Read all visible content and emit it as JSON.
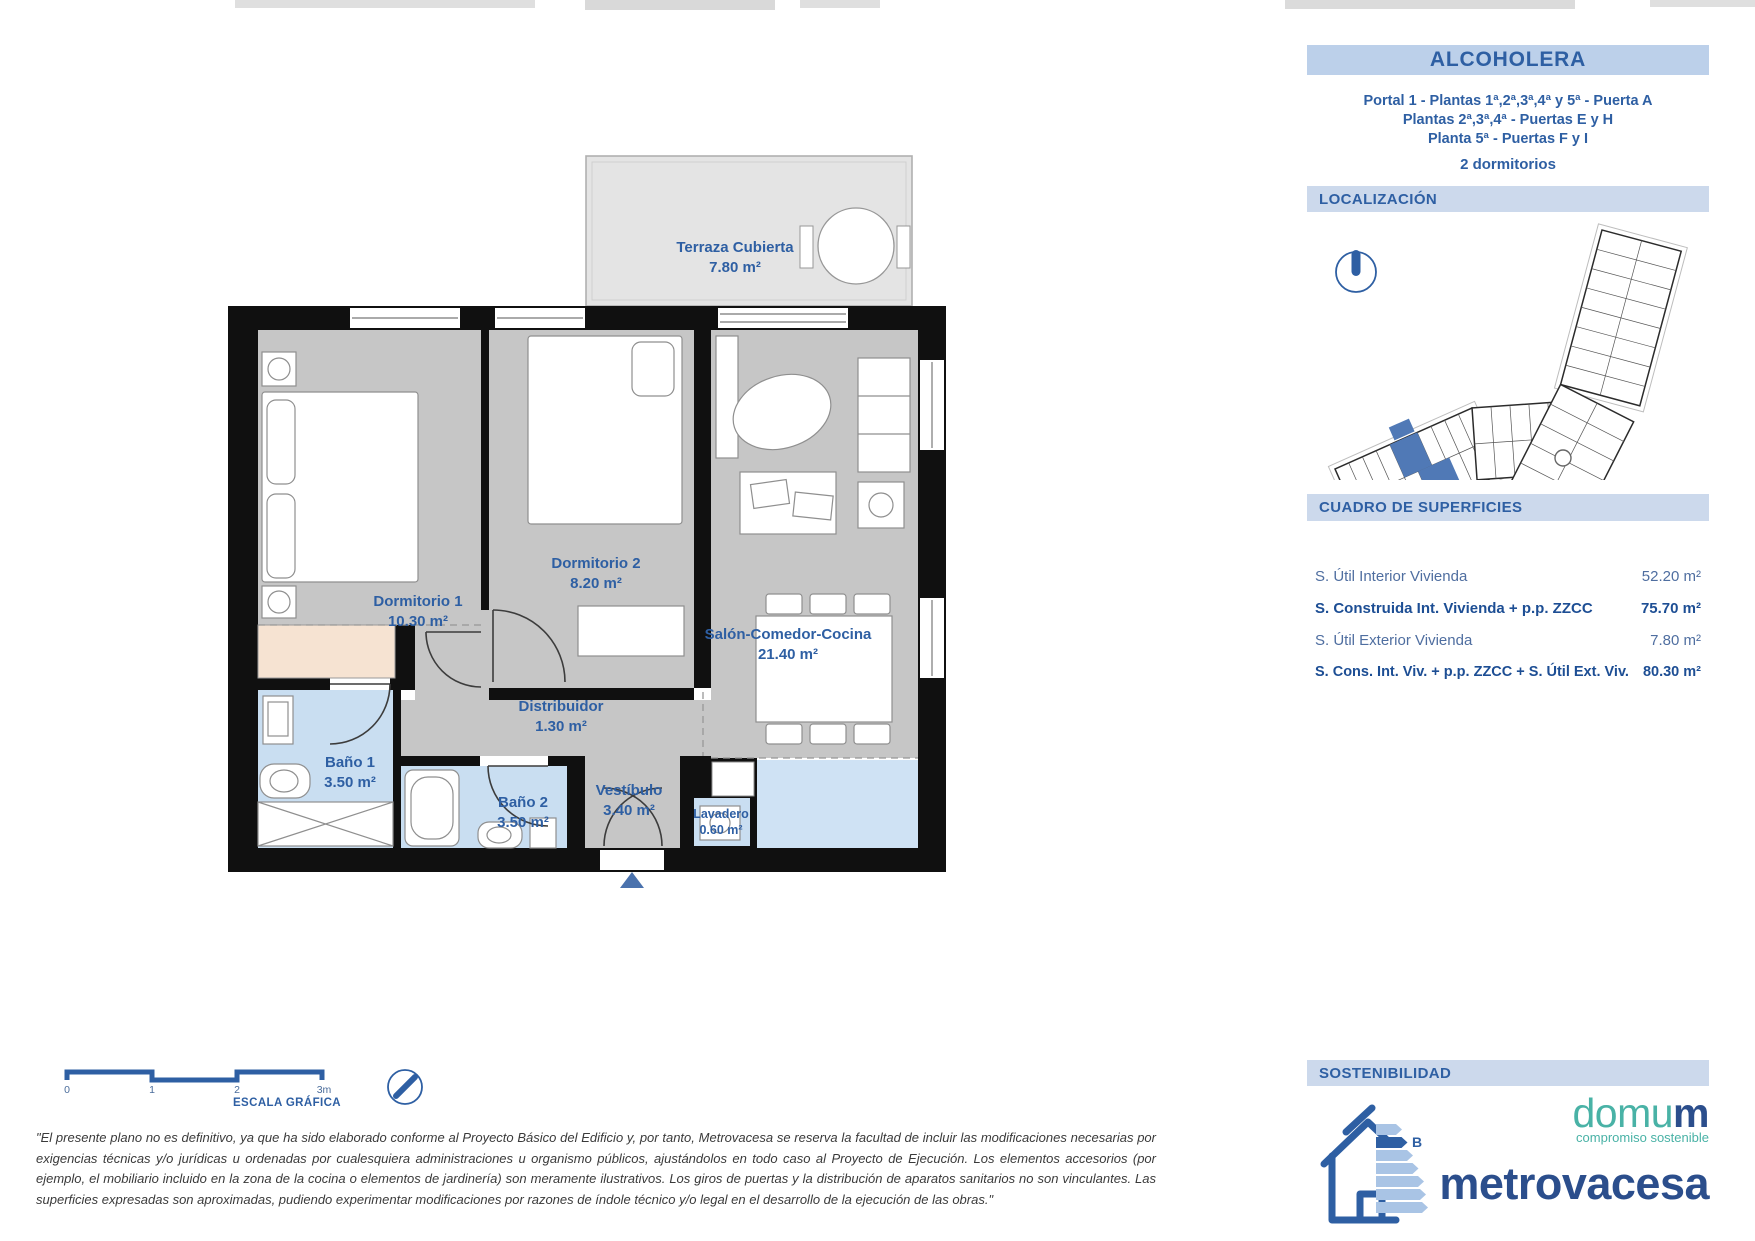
{
  "top_header": {
    "title": "ALCOHOLERA",
    "line1": "Portal 1 - Plantas 1ª,2ª,3ª,4ª y 5ª - Puerta A",
    "line2": "Plantas 2ª,3ª,4ª - Puertas E y H",
    "line3": "Planta 5ª - Puertas F y I",
    "bedrooms": "2 dormitorios"
  },
  "localizacion": {
    "title": "LOCALIZACIÓN"
  },
  "superficies": {
    "title": "CUADRO DE SUPERFICIES",
    "rows": [
      {
        "label": "S. Útil Interior Vivienda",
        "value": "52.20 m²",
        "bold": false
      },
      {
        "label": "S. Construida Int. Vivienda + p.p. ZZCC",
        "value": "75.70 m²",
        "bold": true
      },
      {
        "label": "S. Útil Exterior Vivienda",
        "value": "7.80 m²",
        "bold": false
      },
      {
        "label": "S. Cons. Int. Viv. + p.p. ZZCC + S. Útil Ext. Viv.",
        "value": "80.30 m²",
        "bold": true
      }
    ]
  },
  "sostenibilidad": {
    "title": "SOSTENIBILIDAD",
    "energy_rating": "B"
  },
  "brand": {
    "domum_prefix": "domu",
    "domum_suffix": "m",
    "tagline": "compromiso sostenible",
    "company": "metrovacesa"
  },
  "rooms": [
    {
      "name": "Terraza Cubierta",
      "area": "7.80 m²"
    },
    {
      "name": "Dormitorio 1",
      "area": "10.30 m²"
    },
    {
      "name": "Dormitorio 2",
      "area": "8.20 m²"
    },
    {
      "name": "Salón-Comedor-Cocina",
      "area": "21.40 m²"
    },
    {
      "name": "Distribuidor",
      "area": "1.30 m²"
    },
    {
      "name": "Baño 1",
      "area": "3.50 m²"
    },
    {
      "name": "Baño 2",
      "area": "3.50 m²"
    },
    {
      "name": "Vestíbulo",
      "area": "3.40 m²"
    },
    {
      "name": "Lavadero",
      "area": "0.60 m²"
    }
  ],
  "scale": {
    "ticks": [
      "0",
      "1",
      "2",
      "3m"
    ],
    "label": "ESCALA GRÁFICA"
  },
  "disclaimer": "\"El presente plano no es definitivo, ya que ha sido elaborado conforme al Proyecto Básico del Edificio y, por tanto, Metrovacesa se reserva la facultad de incluir las modificaciones necesarias por exigencias técnicas y/o jurídicas u ordenadas por cualesquiera administraciones u organismo públicos, ajustándolos en todo caso al Proyecto de Ejecución. Los elementos accesorios (por ejemplo, el mobiliario incluido en la zona de la cocina o elementos de jardinería) son meramente ilustrativos. Los giros de puertas y la distribución de aparatos sanitarios no son vinculantes. Las superficies expresadas son aproximadas, pudiendo experimentar modificaciones por razones de índole técnico y/o legal en el desarrollo de la ejecución de las obras.\"",
  "colors": {
    "accent_blue": "#2e5fa3",
    "title_bar_bg": "#bcd0ea",
    "section_bar_bg": "#ccd9ec",
    "floor_gray": "#c6c6c6",
    "terrace_gray": "#e4e4e4",
    "bath_blue": "#c9def1",
    "wardrobe_beige": "#f6e3d2",
    "wall_black": "#101010",
    "unit_highlight_blue": "#5079b6",
    "domum_teal": "#49b2a6",
    "metrovacesa_navy": "#2b4e8c"
  }
}
